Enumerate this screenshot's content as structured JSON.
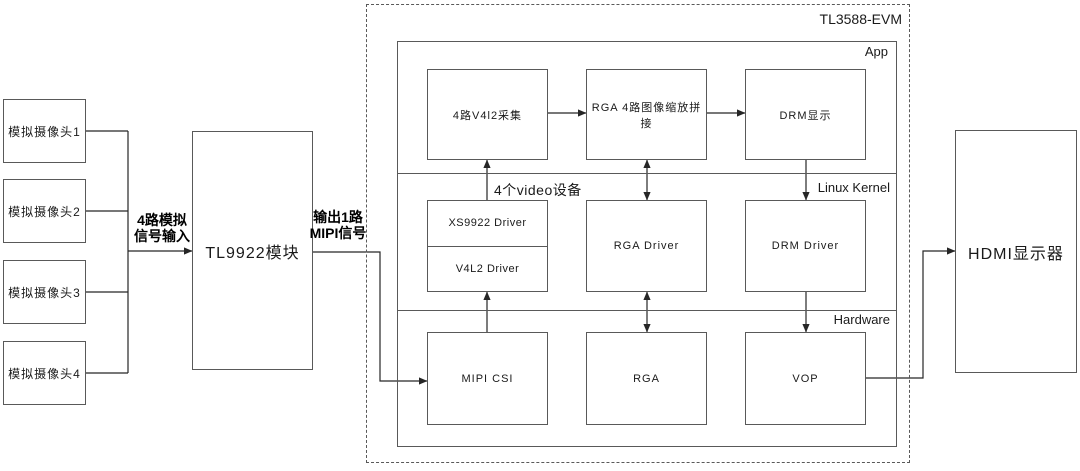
{
  "colors": {
    "background": "#ffffff",
    "box_border": "#595959",
    "wire": "#262626",
    "text": "#1a1a1a"
  },
  "cameras": [
    {
      "label": "模拟摄像头1"
    },
    {
      "label": "模拟摄像头2"
    },
    {
      "label": "模拟摄像头3"
    },
    {
      "label": "模拟摄像头4"
    }
  ],
  "labels": {
    "analog_input_line1": "4路模拟",
    "analog_input_line2": "信号输入",
    "mipi_output_line1": "输出1路",
    "mipi_output_line2": "MIPI信号",
    "video_devices": "4个video设备"
  },
  "tl9922_module": {
    "label": "TL9922模块"
  },
  "evm": {
    "title": "TL3588-EVM",
    "layers": {
      "app": "App",
      "kernel": "Linux Kernel",
      "hardware": "Hardware"
    },
    "app_boxes": [
      {
        "label": "4路V4l2采集"
      },
      {
        "label": "RGA 4路图像缩放拼接"
      },
      {
        "label": "DRM显示"
      }
    ],
    "kernel_boxes": {
      "xs9922": "XS9922 Driver",
      "v4l2": "V4L2 Driver",
      "rga": "RGA Driver",
      "drm": "DRM Driver"
    },
    "hardware_boxes": [
      {
        "label": "MIPI CSI"
      },
      {
        "label": "RGA"
      },
      {
        "label": "VOP"
      }
    ]
  },
  "hdmi_display": {
    "label": "HDMI显示器"
  }
}
